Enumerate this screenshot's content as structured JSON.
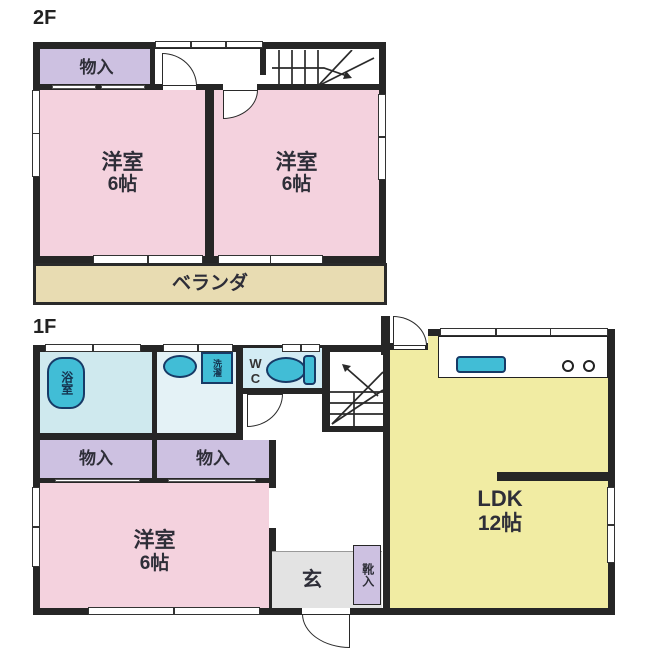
{
  "floor2": {
    "label": "2F",
    "closet_label": "物入",
    "room_left_name": "洋室",
    "room_left_size": "6帖",
    "room_right_name": "洋室",
    "room_right_size": "6帖",
    "veranda_label": "ベランダ"
  },
  "floor1": {
    "label": "1F",
    "bath_label": "浴室",
    "laundry_label": "洗濯",
    "wc_label": "WC",
    "closet_left_label": "物入",
    "closet_right_label": "物入",
    "room_name": "洋室",
    "room_size": "6帖",
    "entrance_label": "玄",
    "shoe_label": "靴入",
    "ldk_name": "LDK",
    "ldk_size": "12帖"
  },
  "colors": {
    "wall": "#262626",
    "room_pink": "#f4d2de",
    "closet_lavender": "#cdc1e1",
    "veranda_beige": "#e8dcb2",
    "bath_blue": "#cfe9ee",
    "washroom_blue": "#e4f2f6",
    "wc_blue": "#d3ecf4",
    "ldk_yellow": "#f1eca3",
    "fixture_teal": "#41bdd6",
    "fixture_outline": "#173a66",
    "entrance_gray": "#e3e3e3"
  }
}
